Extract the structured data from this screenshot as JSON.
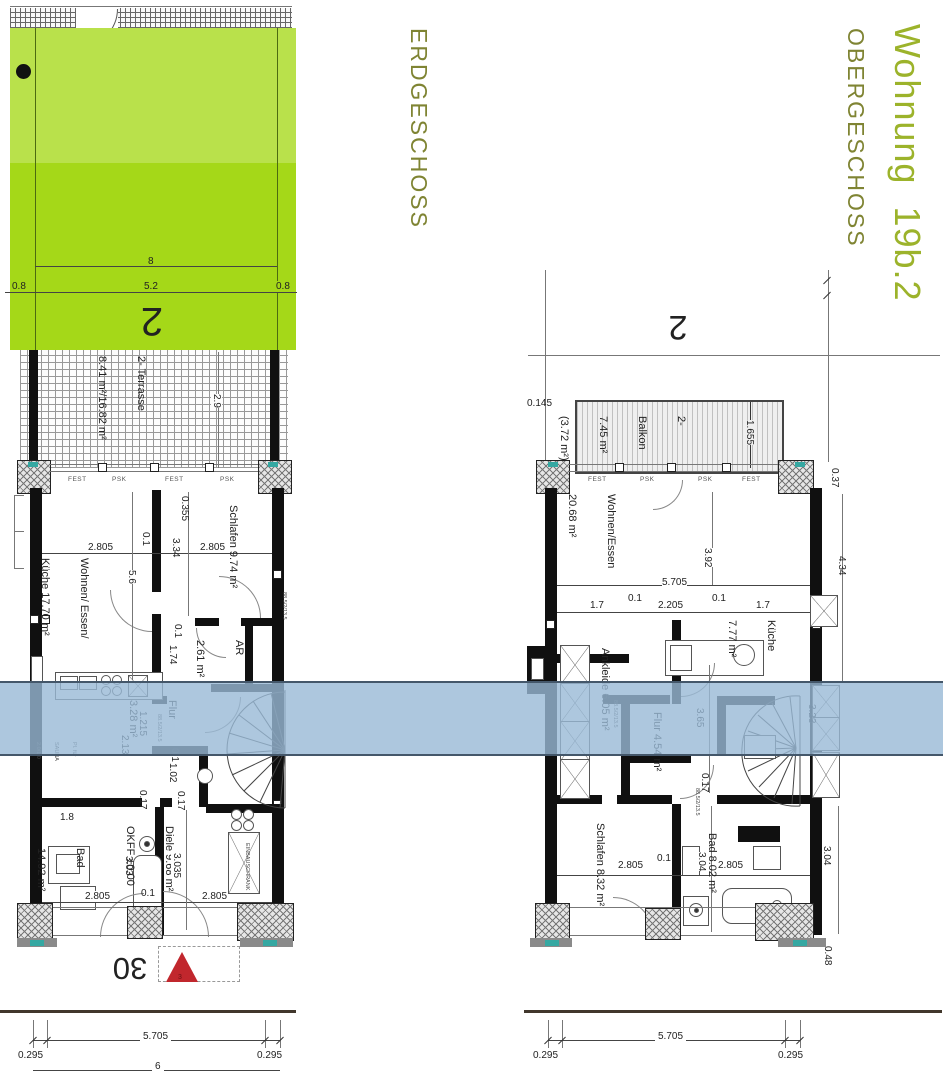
{
  "titles": {
    "floor_left": "ERDGESCHOSS",
    "apartment": "Wohnung  19b.2",
    "floor_right": "OBERGESCHOSS"
  },
  "colors": {
    "garden_light": "#b9e14b",
    "garden_dark": "#a5d818",
    "band_blue": "#98b9d6",
    "band_edge": "#44576a",
    "title_green": "#9cb32b",
    "title_olive": "#7f8433",
    "marker_red": "#c1272d"
  },
  "eg": {
    "number": "2",
    "house_number": "30",
    "triangle_label": "3",
    "garden": {
      "total": "8",
      "l": "0.8",
      "m": "5.2",
      "r": "0.8"
    },
    "terrasse": {
      "l1": "2- Terrasse",
      "l2": "8.41 m²/16.82 m²"
    },
    "tags": {
      "t1": "FEST",
      "t2": "PSK",
      "t3": "FEST",
      "t4": "PSK"
    },
    "rooms": {
      "schlafen": "Schlafen 9.74 m²",
      "wohnen1": "Wohnen/ Essen/",
      "wohnen2": "Küche 17.70 m²",
      "ar1": "AR",
      "ar2": "2.61 m²",
      "flur1": "Flur",
      "flur2": "3.28 m²",
      "bad1": "Bad",
      "bad2": "14.92 m²",
      "diele1": "Diele 9.68 m²",
      "diele2": "OKFF ±0.00"
    },
    "ann": {
      "sauna1": "Pl. für",
      "sauna2": "SAUNA",
      "sauna3": "2.0/1.0",
      "schrank": "EINBAUSCHRANK",
      "door_tag": "88.5/2/13.5"
    },
    "dims": {
      "d29": "2.9",
      "d0355": "0.355",
      "d2805a": "2.805",
      "d01a": "0.1",
      "d334": "3.34",
      "d2805b": "2.805",
      "d56": "5.6",
      "d01b": "0.1",
      "d174": "1.74",
      "d1215": "1.215",
      "d213": "2.13",
      "d01c": "0.1",
      "d102": "1.02",
      "d017a": "0.17",
      "d017b": "0.17",
      "d18": "1.8",
      "d303": "3.03",
      "d3035": "3.035",
      "d01d": "0.1",
      "d2805c": "2.805",
      "d2805d": "2.805"
    },
    "bottom": {
      "d5705": "5.705",
      "l295": "0.295",
      "r295": "0.295",
      "d6": "6"
    }
  },
  "og": {
    "number": "2",
    "balkon": {
      "l1": "2-",
      "l2": "Balkon",
      "l3": "7.45 m²",
      "l4": "(3.72 m²)"
    },
    "tags": {
      "t1": "FEST",
      "t2": "PSK",
      "t3": "PSK",
      "t4": "FEST"
    },
    "rooms": {
      "wohnen1": "Wohnen/Essen",
      "wohnen2": "20.68 m²",
      "kueche1": "Küche",
      "kueche2": "7.77 m²",
      "ankleide": "Ankleide 6.05 m²",
      "flur": "Flur 4.54 m²",
      "schlafen": "Schlafen 8.32 m²",
      "bad": "Bad 8.02 m²"
    },
    "dims": {
      "d0145": "0.145",
      "d1655": "1.655",
      "d037": "0.37",
      "d392": "3.92",
      "d5705": "5.705",
      "d17a": "1.7",
      "d01a": "0.1",
      "d2205": "2.205",
      "d01b": "0.1",
      "d17b": "1.7",
      "d434": "4.34",
      "d365": "3.65",
      "d323": "3.23",
      "d017": "0.17",
      "d2805a": "2.805",
      "d01c": "0.1",
      "d304a": "3.04",
      "d2805b": "2.805",
      "d304b": "3.04",
      "d048": "0.48"
    },
    "bottom": {
      "d5705": "5.705",
      "l295": "0.295",
      "r295": "0.295"
    }
  }
}
